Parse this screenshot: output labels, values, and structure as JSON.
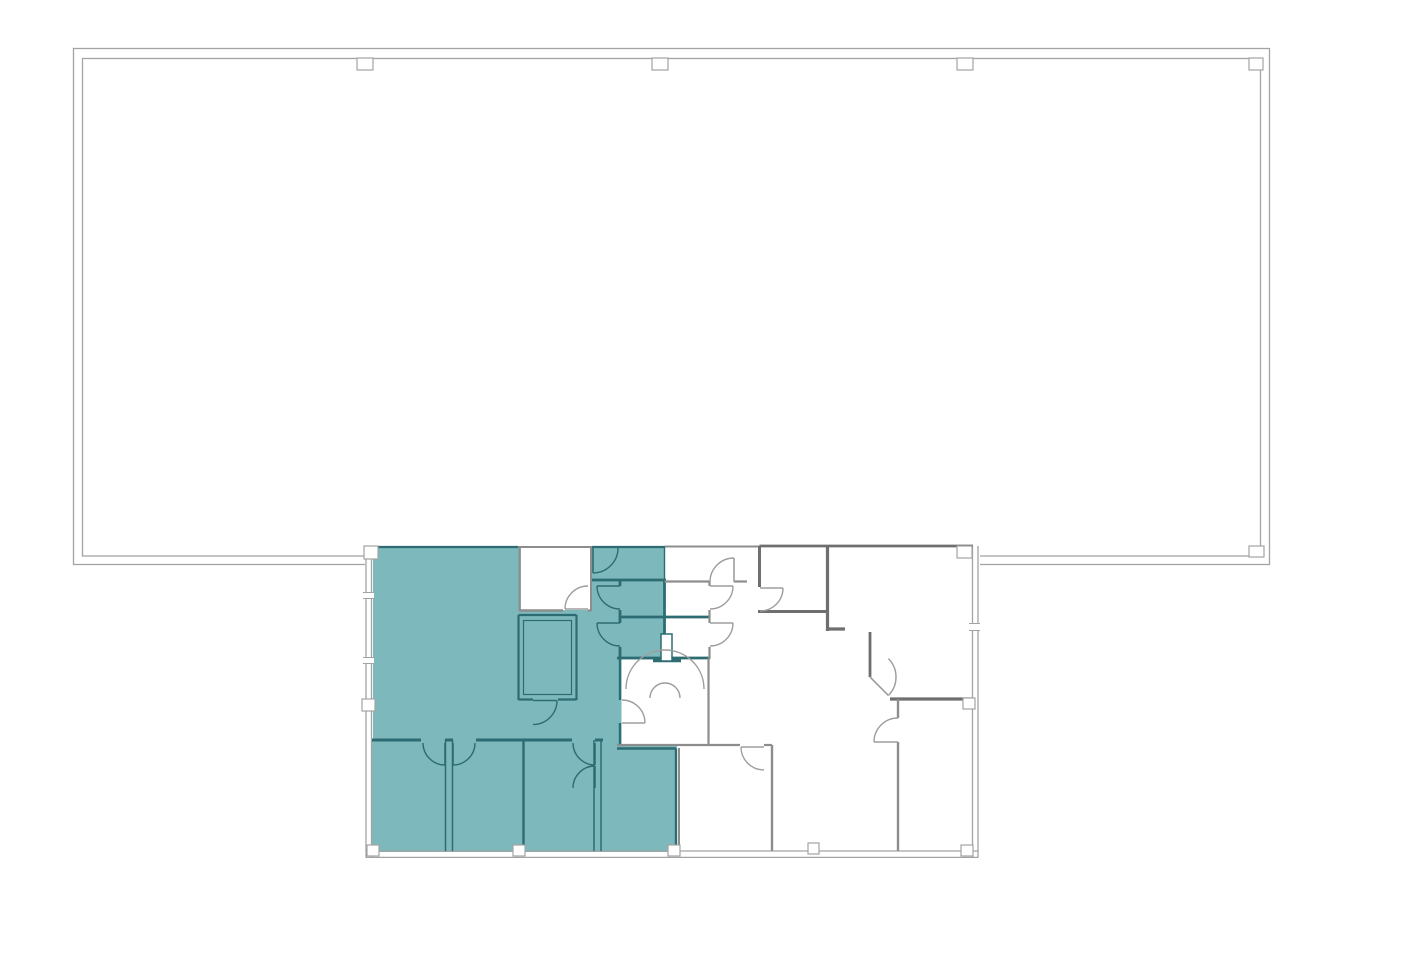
{
  "canvas": {
    "width": 1423,
    "height": 975,
    "background": "#ffffff"
  },
  "colors": {
    "background": "#ffffff",
    "suite_fill": "#7db9bc",
    "suite_wall": "#2d6c72",
    "wall_light": "#a3a3a3",
    "wall_medium": "#8d8d8d",
    "wall_dark": "#6f6f6f",
    "door_gray": "#9d9d9d",
    "column_fill": "#ffffff"
  },
  "plan": {
    "building_outline": {
      "outer_rect": [
        73.5,
        48.5,
        1196,
        516
      ],
      "inner_rect": [
        82.5,
        58.5,
        1178,
        497.5
      ]
    },
    "annex_bg_rect": [
      365,
      541,
      615,
      321
    ],
    "suite_fill_rects": [
      [
        373,
        547,
        292,
        197
      ],
      [
        371,
        740,
        306,
        112
      ]
    ],
    "room_interior_rects": [
      [
        521,
        548,
        69,
        62
      ],
      [
        621.5,
        659.5,
        86.5,
        84.5
      ]
    ],
    "walls": [
      [
        366,
        556,
        366,
        858,
        "L",
        1.3
      ],
      [
        371.5,
        556,
        371.5,
        858,
        "L",
        1.3
      ],
      [
        366,
        857.4,
        978.6,
        857.4,
        "L",
        1.3
      ],
      [
        366,
        851,
        978.6,
        851,
        "L",
        1.3
      ],
      [
        978,
        546,
        978,
        857.4,
        "L",
        1.3
      ],
      [
        972.5,
        546,
        972.5,
        857.4,
        "L",
        1.3
      ],
      [
        372,
        547,
        518,
        547,
        "t",
        2.2
      ],
      [
        518,
        547,
        592,
        547,
        "g",
        2
      ],
      [
        592,
        547,
        665,
        547,
        "t",
        2.2
      ],
      [
        665,
        546.5,
        759.5,
        546.5,
        "g",
        2
      ],
      [
        759.5,
        546,
        973,
        546,
        "d",
        2.8
      ],
      [
        591,
        580,
        666,
        580,
        "t",
        2.8
      ],
      [
        664.5,
        547,
        664.5,
        580,
        "t",
        1.4
      ],
      [
        664.5,
        580,
        664.5,
        658,
        "t",
        2.8
      ],
      [
        620,
        580,
        620,
        586,
        "t",
        2.8
      ],
      [
        620,
        610,
        620,
        623,
        "t",
        2.8
      ],
      [
        620,
        647,
        620,
        658,
        "t",
        2.8
      ],
      [
        620,
        617,
        710,
        617,
        "t",
        2.8
      ],
      [
        617,
        658,
        710,
        658,
        "t",
        2.8
      ],
      [
        620,
        658,
        620,
        700,
        "t",
        2.4
      ],
      [
        620,
        723,
        620,
        745,
        "t",
        2.4
      ],
      [
        372,
        740,
        421,
        740,
        "t",
        3
      ],
      [
        445,
        740,
        453,
        740,
        "t",
        3
      ],
      [
        476,
        740,
        572,
        740,
        "t",
        3
      ],
      [
        595,
        740,
        603,
        740,
        "t",
        3
      ],
      [
        445.5,
        740,
        445.5,
        851,
        "t",
        1.5
      ],
      [
        452.5,
        740,
        452.5,
        851,
        "t",
        1.5
      ],
      [
        523.5,
        740,
        523.5,
        851,
        "t",
        2.4
      ],
      [
        594,
        740,
        594,
        851,
        "t",
        1.5
      ],
      [
        601,
        740,
        601,
        851,
        "t",
        1.5
      ],
      [
        617,
        748.5,
        676,
        748.5,
        "t",
        2.4
      ],
      [
        676,
        748.5,
        676,
        851,
        "t",
        2.4
      ],
      [
        653,
        660.5,
        681,
        660.5,
        "t",
        3.6
      ],
      [
        519.5,
        548,
        519.5,
        611,
        "g",
        2
      ],
      [
        591,
        548,
        591,
        611,
        "g",
        2
      ],
      [
        519.5,
        610.5,
        563,
        610.5,
        "g",
        2.4
      ],
      [
        588,
        610.5,
        591,
        610.5,
        "g",
        2.4
      ],
      [
        518.5,
        615,
        518.5,
        700,
        "t",
        2.2
      ],
      [
        576.5,
        615,
        576.5,
        700,
        "t",
        2.2
      ],
      [
        518.5,
        615,
        576.5,
        615,
        "t",
        2.2
      ],
      [
        518.5,
        699.5,
        533,
        699.5,
        "t",
        2.2
      ],
      [
        558,
        699.5,
        576.5,
        699.5,
        "t",
        2.2
      ],
      [
        664.5,
        581.5,
        710,
        581.5,
        "g",
        2.2
      ],
      [
        734,
        581.5,
        747,
        581.5,
        "g",
        2.2
      ],
      [
        759.5,
        546,
        759.5,
        587,
        "d",
        3
      ],
      [
        758,
        611.5,
        829,
        611.5,
        "d",
        3
      ],
      [
        827.5,
        546,
        827.5,
        631,
        "d",
        3.2
      ],
      [
        827.5,
        629,
        845,
        629,
        "d",
        3.2
      ],
      [
        709.5,
        581.5,
        709.5,
        586,
        "g",
        2.2
      ],
      [
        709.5,
        610,
        709.5,
        623,
        "g",
        2.2
      ],
      [
        709.5,
        647,
        709.5,
        659,
        "g",
        2.2
      ],
      [
        870,
        632,
        870,
        677,
        "d",
        2.8
      ],
      [
        890,
        699,
        972.5,
        699,
        "d",
        3.2
      ],
      [
        898,
        699,
        898,
        718,
        "g",
        2.4
      ],
      [
        898,
        742,
        898,
        851,
        "g",
        2.4
      ],
      [
        617,
        745,
        740,
        745,
        "g",
        2.2
      ],
      [
        764,
        745,
        772,
        745,
        "g",
        2.2
      ],
      [
        772,
        745,
        772,
        851,
        "g",
        2.4
      ],
      [
        679,
        748,
        679,
        851,
        "g",
        2
      ],
      [
        708.5,
        658,
        708.5,
        745,
        "g",
        2.2
      ]
    ],
    "closet_inner_rect": [
      523.5,
      620.5,
      48,
      74
    ],
    "pillar_rect": [
      661,
      634,
      11,
      27
    ],
    "wall_break_rects": [
      [
        363,
        592,
        11,
        7
      ],
      [
        363,
        657,
        11,
        7
      ],
      [
        969,
        623,
        11,
        8
      ]
    ],
    "wall_break_ticks": [
      [
        363,
        592.5,
        374,
        592.5
      ],
      [
        363,
        598.5,
        374,
        598.5
      ],
      [
        363,
        657.5,
        374,
        657.5
      ],
      [
        363,
        663.5,
        374,
        663.5
      ],
      [
        969,
        623.5,
        980,
        623.5
      ],
      [
        969,
        630.5,
        980,
        630.5
      ]
    ],
    "columns": [
      [
        357,
        58,
        16,
        12
      ],
      [
        652,
        58,
        16,
        12
      ],
      [
        957,
        58,
        16,
        12
      ],
      [
        1249,
        58,
        14,
        12
      ],
      [
        1249,
        546,
        15,
        11
      ],
      [
        364,
        546,
        14,
        13
      ],
      [
        957,
        546,
        15,
        12
      ],
      [
        367,
        845,
        12,
        11
      ],
      [
        513,
        845,
        12,
        11
      ],
      [
        668,
        845,
        12,
        11
      ],
      [
        808,
        843,
        11,
        11
      ],
      [
        961,
        845,
        12,
        11
      ],
      [
        963,
        698,
        12,
        11
      ],
      [
        362,
        699,
        13,
        12
      ]
    ],
    "doors": [
      [
        588,
        609,
        23,
        180,
        270,
        "g"
      ],
      [
        533,
        700.5,
        24,
        0,
        90,
        "t"
      ],
      [
        593,
        548,
        25,
        90,
        0,
        "t"
      ],
      [
        620,
        586,
        23,
        180,
        90,
        "t"
      ],
      [
        620,
        623,
        23,
        180,
        90,
        "t"
      ],
      [
        710,
        586,
        23,
        0,
        90,
        "g"
      ],
      [
        710,
        623,
        23,
        0,
        90,
        "g"
      ],
      [
        734,
        582,
        24,
        270,
        180,
        "g"
      ],
      [
        760,
        588,
        23,
        0,
        90,
        "g"
      ],
      [
        622,
        723,
        23,
        0,
        -90,
        "g"
      ],
      [
        445,
        743,
        22,
        90,
        180,
        "t"
      ],
      [
        453,
        743,
        22,
        90,
        0,
        "t"
      ],
      [
        595,
        743,
        22,
        90,
        180,
        "t"
      ],
      [
        595,
        788,
        22,
        270,
        180,
        "t"
      ],
      [
        764,
        747,
        23,
        180,
        90,
        "g"
      ],
      [
        898,
        742,
        24,
        180,
        270,
        "g"
      ],
      [
        870,
        677,
        26,
        45,
        -45,
        "g"
      ]
    ],
    "fixture_arcs": [
      {
        "d": "M 626 689 A 39 39 0 0 1 704 689"
      },
      {
        "d": "M 650 698 A 15 15 0 0 1 680 698"
      }
    ]
  }
}
